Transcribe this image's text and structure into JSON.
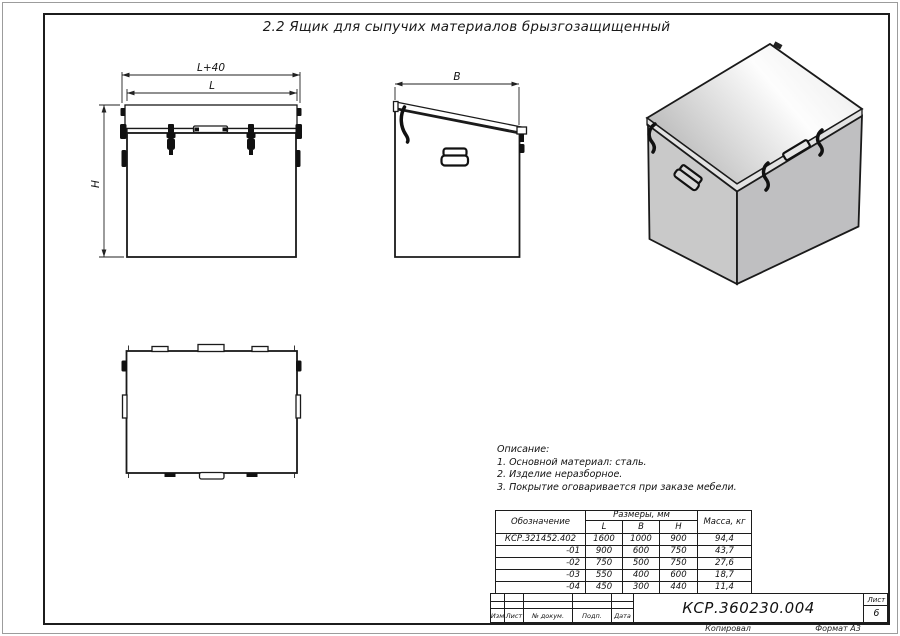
{
  "page": {
    "title": "2.2 Ящик для сыпучих материалов брызгозащищенный"
  },
  "dimensions": {
    "overall_width": "L+40",
    "width": "L",
    "height": "H",
    "depth": "B"
  },
  "description": {
    "heading": "Описание:",
    "items": [
      "1. Основной материал: сталь.",
      "2. Изделие неразборное.",
      "3. Покрытие оговаривается при заказе мебели."
    ]
  },
  "size_table": {
    "designation_header": "Обозначение",
    "dimensions_header": "Размеры, мм",
    "mass_header": "Масса, кг",
    "dim_columns": [
      "L",
      "B",
      "H"
    ],
    "rows": [
      {
        "designation": "КСР.321452.402",
        "L": "1600",
        "B": "1000",
        "H": "900",
        "mass": "94,4"
      },
      {
        "designation": "-01",
        "L": "900",
        "B": "600",
        "H": "750",
        "mass": "43,7"
      },
      {
        "designation": "-02",
        "L": "750",
        "B": "500",
        "H": "750",
        "mass": "27,6"
      },
      {
        "designation": "-03",
        "L": "550",
        "B": "400",
        "H": "600",
        "mass": "18,7"
      },
      {
        "designation": "-04",
        "L": "450",
        "B": "300",
        "H": "440",
        "mass": "11,4"
      }
    ]
  },
  "title_block": {
    "revision_labels": [
      "Изм",
      "Лист",
      "№ докум.",
      "Подп.",
      "Дата"
    ],
    "doc_number": "КСР.360230.004",
    "sheet_label": "Лист",
    "sheet_number": "6",
    "copied_label": "Копировал",
    "format_label": "Формат А3"
  },
  "colors": {
    "line": "#1a1a1a",
    "face_left": "#c9c9c9",
    "face_right": "#bfbfc1",
    "lid_highlight": "#ffffff"
  }
}
